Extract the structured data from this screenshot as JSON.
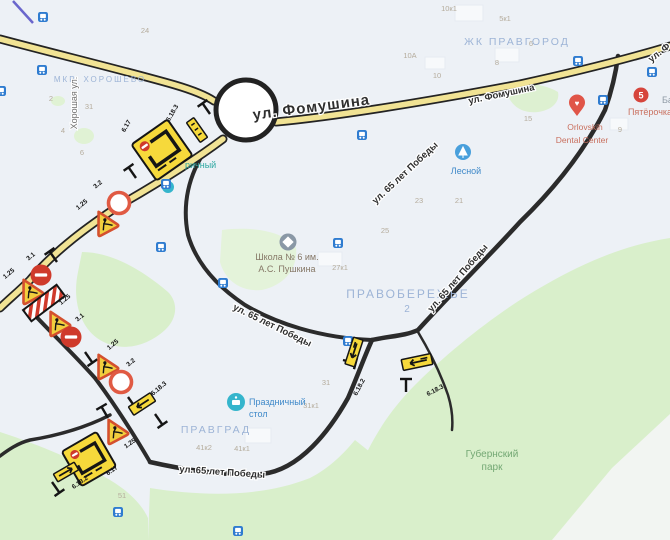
{
  "map": {
    "streets": {
      "fomushina_main": "ул. Фомушина",
      "fomushina_small": "ул. Фомушина",
      "fomushina_corner": "ул. Ф",
      "pobedy": "ул. 65 лет Победы",
      "khoroshaya": "Хорошая ул."
    },
    "districts": {
      "pravgorod": "ЖК ПРАВГОРОД",
      "khoroshevo": "МКР. ХОРОШЕВО",
      "pravoberezhye": "ПРАВОБЕРЕЖЬЕ",
      "pravoberezhye_num": "2",
      "pravgrad": "ПРАВГРАД",
      "gubernsky_line1": "Губернский",
      "gubernsky_line2": "парк"
    },
    "pois": {
      "school_line1": "Школа № 6 им.",
      "school_line2": "А.С. Пушкина",
      "lesnoy": "Лесной",
      "prazdnichny_line1": "Праздничный",
      "prazdnichny_line2": "стол",
      "dental_line1": "Orlovskih",
      "dental_line2": "Dental Center",
      "pyaterochka": "Пятёрочка",
      "ba_clipped": "Ба",
      "richny_partial": "ричный"
    },
    "building_numbers": [
      "24",
      "2",
      "31",
      "4",
      "6",
      "10к1",
      "5к1",
      "10А",
      "10",
      "8",
      "6",
      "15",
      "9",
      "23",
      "21",
      "25",
      "27к1",
      "31",
      "31к1",
      "41к2",
      "41к1",
      "51"
    ],
    "sign_labels": {
      "a_scheme": "6.17",
      "a_dir": "6.18.3",
      "b_ring": "3.2",
      "b_works": "1.25",
      "c_brick_top": "3.1",
      "c_works_top": "1.25",
      "c_works_mid": "1.25",
      "c_brick_low": "3.1",
      "d_works": "1.25",
      "d_ring": "3.2",
      "d_dir": "6.18.3",
      "e_works": "1.25",
      "e_scheme": "6.17",
      "e_dir": "6.18.2",
      "f_left": "6.18.2",
      "f_right": "6.18.3"
    },
    "colors": {
      "background": "#edf1f6",
      "park_green": "#d9efcb",
      "road_yellow": "#f1e394",
      "road_casing": "#232323",
      "sign_yellow": "#f6d93b",
      "sign_red": "#cf3a2b",
      "works_border": "#d4502e",
      "bus_blue": "#2f7cd0",
      "district_text": "#9db4d6",
      "pen_mark": "#5b57c8"
    }
  }
}
